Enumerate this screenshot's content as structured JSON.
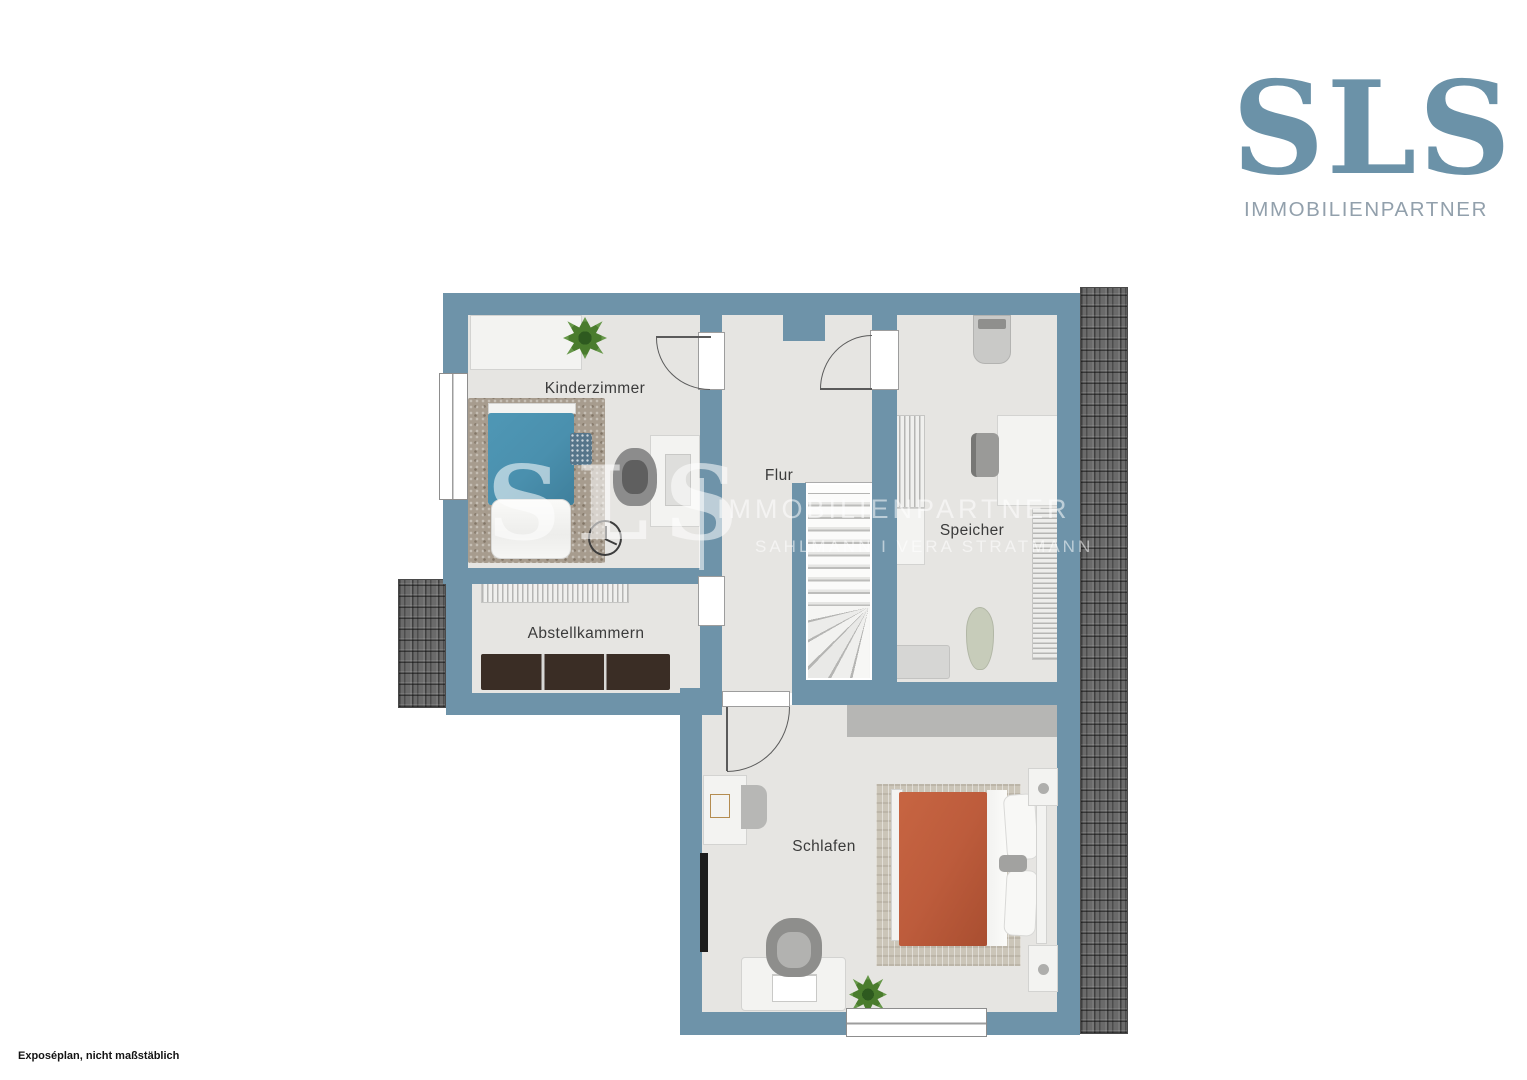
{
  "brand": {
    "name": "SLS",
    "subtitle": "IMMOBILIENPARTNER"
  },
  "watermark": {
    "initials": "SLS",
    "title": "IMMOBILIENPARTNER",
    "subtitle": "SAHLMANN I VERA STRATMANN"
  },
  "plan": {
    "rooms": {
      "kinderzimmer": "Kinderzimmer",
      "flur": "Flur",
      "speicher": "Speicher",
      "abstellkammern": "Abstellkammern",
      "schlafen": "Schlafen"
    }
  },
  "footnote": "Exposéplan, nicht maßstäblich",
  "colors": {
    "wall": "#6e93a9",
    "floor": "#e6e5e2",
    "roof_tiles": "#6a6a6a",
    "logo_blue": "#6b92a8",
    "logo_gray": "#92a0ac",
    "kids_bed": "#4a90ae",
    "master_bed": "#bd5c3c",
    "sideboard": "#3a2d25"
  }
}
